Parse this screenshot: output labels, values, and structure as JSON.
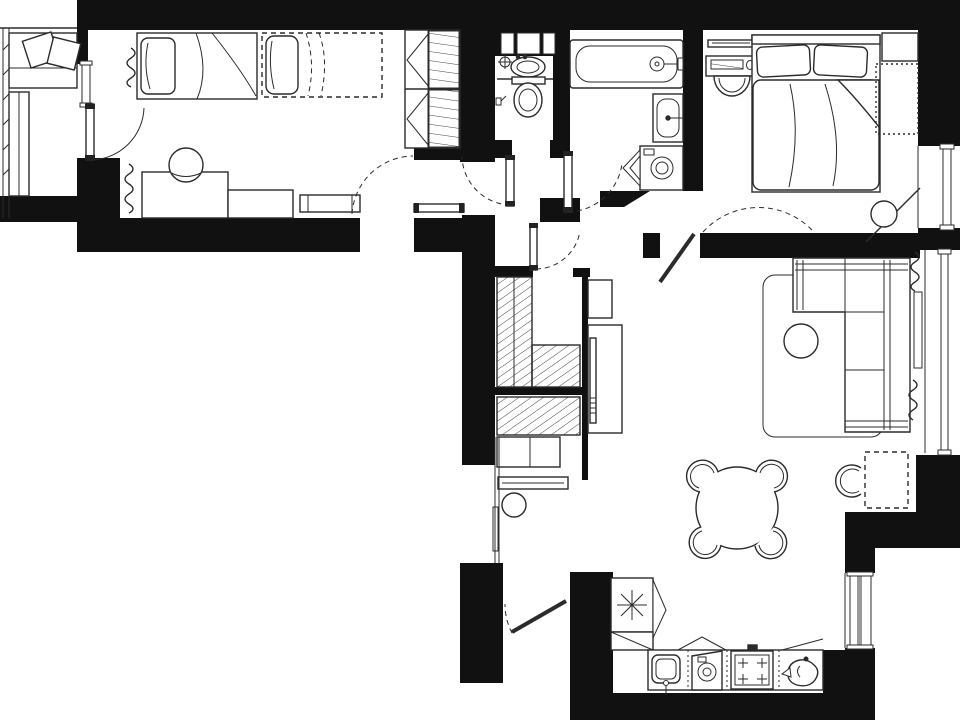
{
  "meta": {
    "type": "architectural-floor-plan",
    "style": "black-and-white line drawing, top-down apartment plan",
    "visible_text": ""
  },
  "colors": {
    "background": "#ffffff",
    "walls": "#111111",
    "lines": "#2b2b2b",
    "glass": "#9a9a9a",
    "furniture_fill": "#ffffff"
  },
  "rooms": [
    {
      "id": "balcony",
      "furniture": [
        "bench-with-pillows",
        "long-bench",
        "glazed-wall"
      ]
    },
    {
      "id": "kids-bedroom",
      "furniture": [
        "single-bed-1",
        "single-bed-2-dashed",
        "wardrobe-hinged-doors",
        "desk-l-shaped",
        "desk-chair",
        "small-bench",
        "radiator-upper",
        "radiator-lower",
        "balcony-door",
        "window"
      ]
    },
    {
      "id": "wc",
      "furniture": [
        "wall-niches-x3",
        "washbasin",
        "faucet-cross",
        "toilet",
        "wall-sprayer",
        "door"
      ]
    },
    {
      "id": "bathroom",
      "furniture": [
        "bathtub",
        "tub-faucet",
        "washbasin",
        "washing-machine-open-door",
        "door"
      ]
    },
    {
      "id": "bedroom",
      "furniture": [
        "vanity-mirror",
        "vanity-table",
        "stool",
        "double-bed",
        "pillows-x2",
        "duvet",
        "nightstand",
        "dashed-wardrobe-zone",
        "corner-shelf-diagonal",
        "corner-plant",
        "window",
        "door"
      ]
    },
    {
      "id": "living-room",
      "furniture": [
        "corner-sofa",
        "rug",
        "pouf",
        "tv-console",
        "tv",
        "shelf",
        "windowsill-console",
        "radiator-upper",
        "radiator-lower",
        "window"
      ]
    },
    {
      "id": "dining-area",
      "furniture": [
        "round-table",
        "chairs-x4",
        "extra-chair",
        "dashed-planned-cabinet"
      ]
    },
    {
      "id": "kitchen",
      "furniture": [
        "fridge-freezer-snowflake",
        "corner-cabinet",
        "sink",
        "dishwasher",
        "stove-4-burners",
        "kettle",
        "counter",
        "window"
      ]
    },
    {
      "id": "hallway",
      "furniture": [
        "closet-hatched-tall",
        "closet-hatched-low",
        "wardrobe-hatched",
        "cabinets",
        "console-shelf",
        "round-mirror",
        "closet-door",
        "entrance-door"
      ]
    }
  ],
  "doors": [
    "balcony-door",
    "kids-room-door",
    "wc-door",
    "bathroom-door",
    "bedroom-door",
    "closet-door",
    "entrance-door"
  ],
  "windows": [
    "balcony-glazing",
    "kids-balcony-window",
    "bedroom-window",
    "living-room-window",
    "kitchen-window"
  ],
  "counts": {
    "single-beds": 2,
    "double-beds": 1,
    "dining-chairs": 4,
    "extra-chairs": 1,
    "stove-burners": 4,
    "wc-niches": 3,
    "radiators": 4,
    "windows": 5,
    "doors": 7
  }
}
